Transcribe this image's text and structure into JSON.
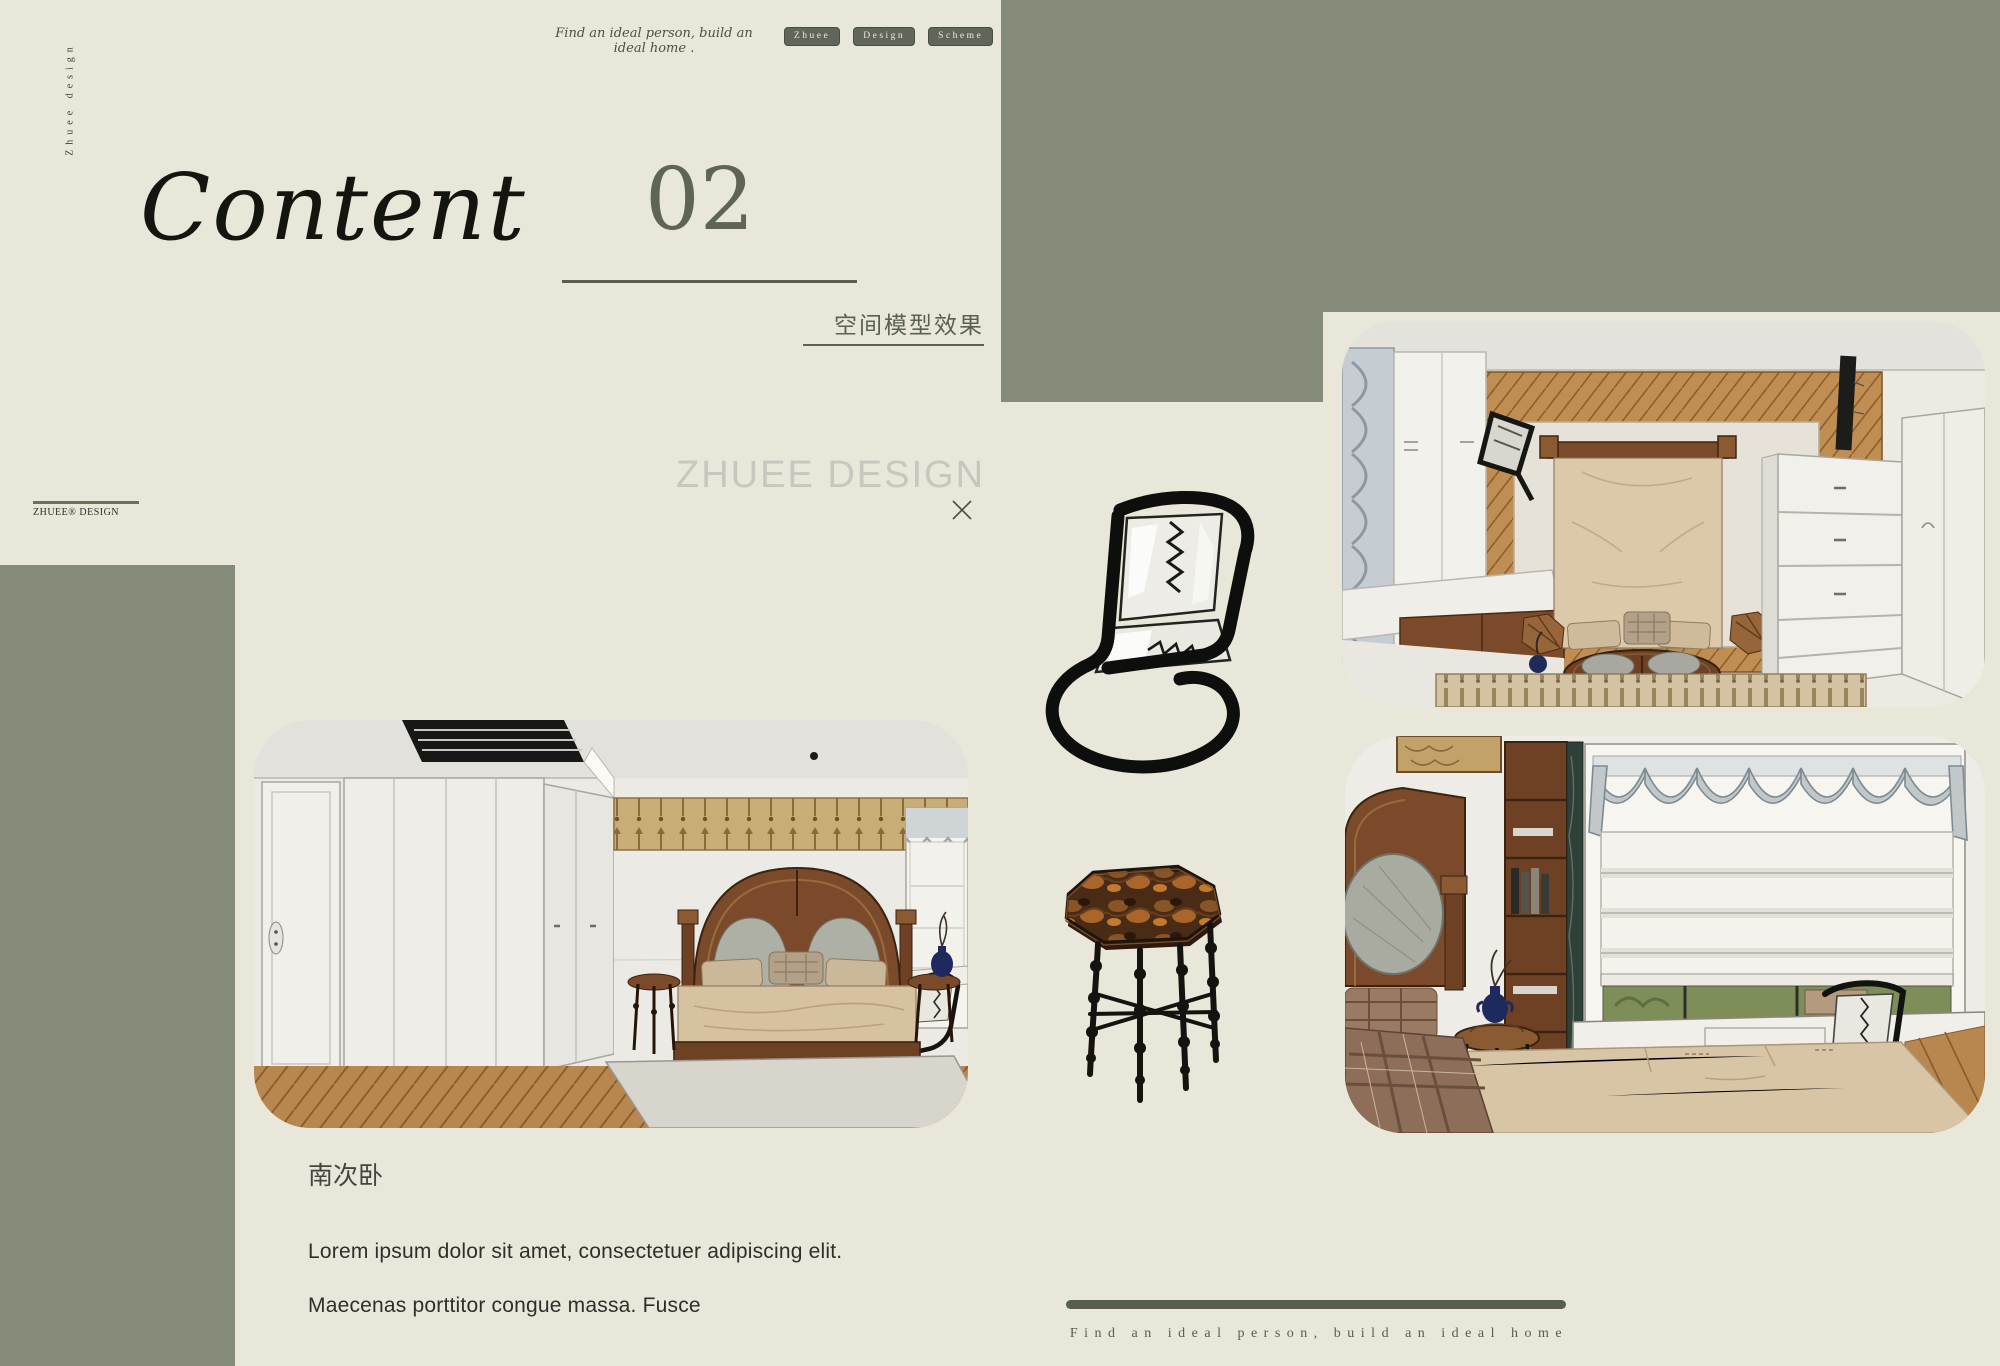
{
  "colors": {
    "background": "#e9e6da",
    "sage_block": "#848b78",
    "dark_green": "#575d4f",
    "ink": "#15150f",
    "watermark_gray": "#c7c7bf"
  },
  "brand": {
    "vertical_text": "Zhuee design",
    "logo_text": "ZHUEE® DESIGN",
    "watermark": "ZHUEE DESIGN"
  },
  "header": {
    "tagline": "Find an ideal person, build an ideal home .",
    "nav": [
      {
        "label": "Zhuee"
      },
      {
        "label": "Design"
      },
      {
        "label": "Scheme"
      }
    ]
  },
  "title_block": {
    "title": "Content",
    "number": "02",
    "caption": "空间模型效果"
  },
  "section": {
    "heading": "南次卧",
    "lines": [
      "Lorem ipsum dolor sit amet, consectetuer adipiscing elit.",
      "Maecenas porttitor congue massa. Fusce"
    ]
  },
  "footer": {
    "tagline": "Find an ideal person, build an ideal home"
  },
  "illustrations": {
    "render_top_right": "3D model render - bedroom overview",
    "render_main": "3D model render - south secondary bedroom",
    "render_bottom_right": "3D model render - bedroom window and desk",
    "chair": "cantilever chair sketch",
    "side_table": "octagonal spindle-leg side table"
  }
}
